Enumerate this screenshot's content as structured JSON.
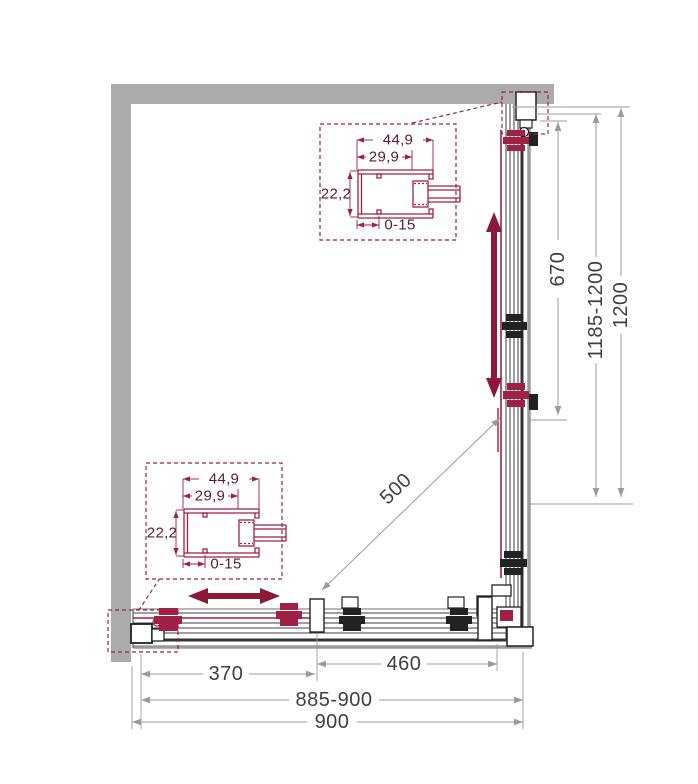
{
  "diagram": {
    "type": "corner-shower-enclosure-plan",
    "detail_callout_top": {
      "outer_width": "44,9",
      "inner_width": "29,9",
      "depth": "22,2",
      "adjustment_range": "0-15"
    },
    "detail_callout_bottom": {
      "outer_width": "44,9",
      "inner_width": "29,9",
      "depth": "22,2",
      "adjustment_range": "0-15"
    },
    "dimensions_bottom": {
      "fixed_panel": "370",
      "door_panel": "460",
      "adjustable_width": "885-900",
      "total_width": "900"
    },
    "dimensions_right": {
      "door_panel": "670",
      "adjustable_depth": "1185-1200",
      "total_depth": "1200"
    },
    "diagonal_entry": "500",
    "colors": {
      "wall_gray": "#ABABAB",
      "accent_red": "#A12045",
      "arrow_red": "#8E1838",
      "line_dark": "#3F3F3F",
      "dimension_gray": "#9B9B9B"
    }
  }
}
